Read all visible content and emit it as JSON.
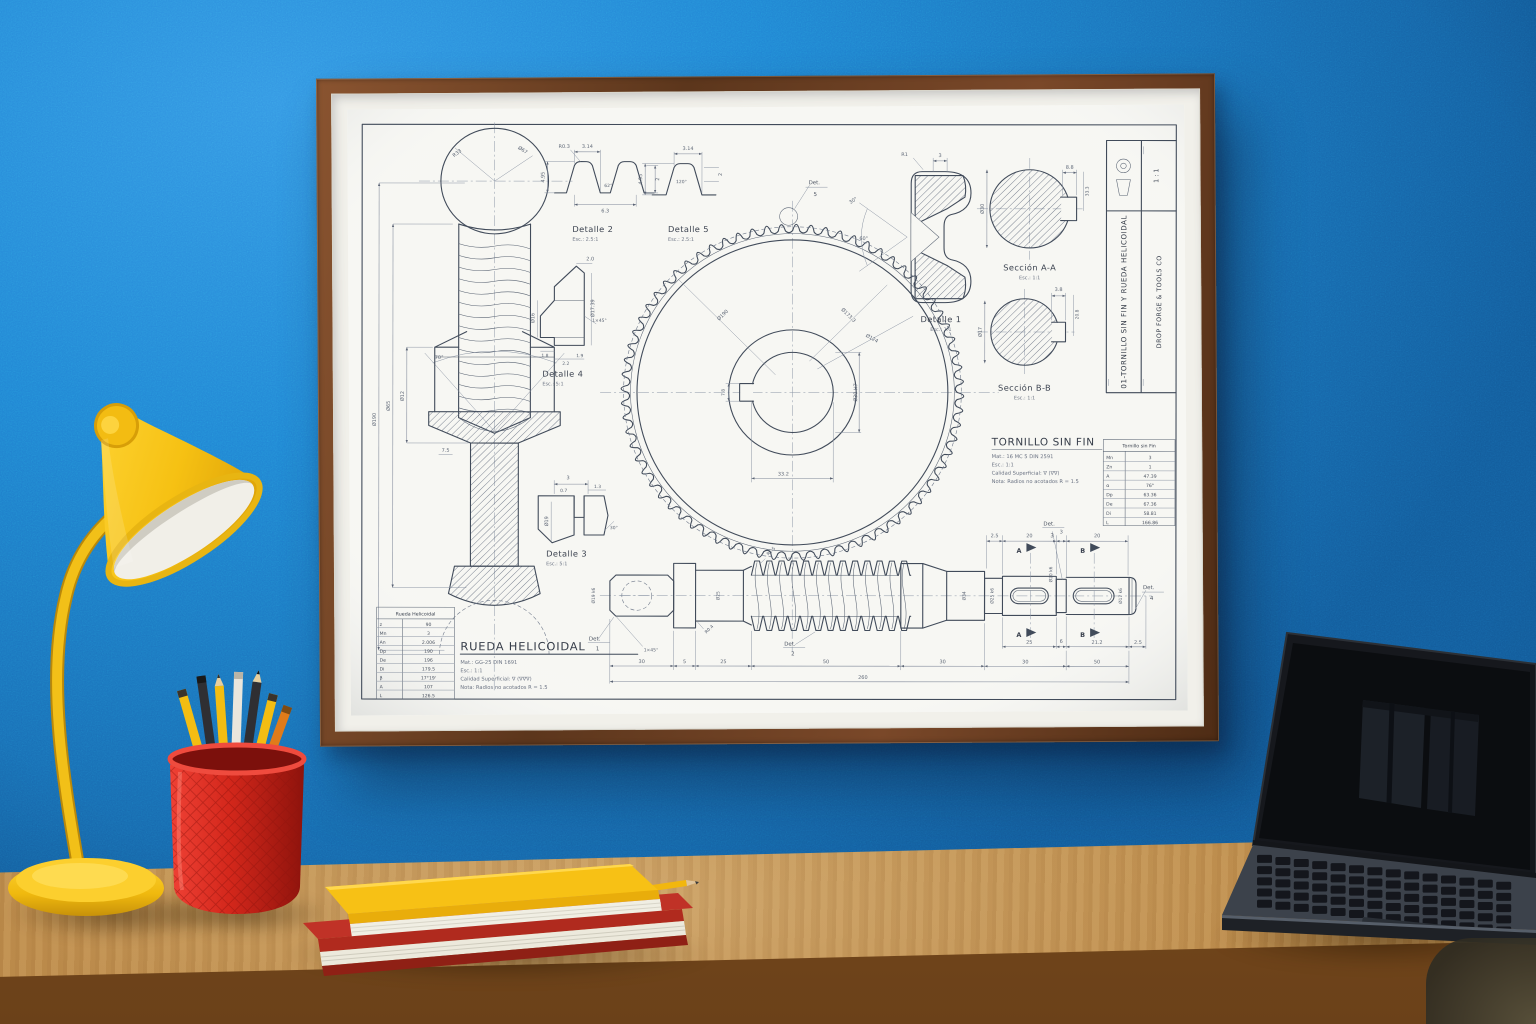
{
  "scene": {
    "description": "Framed mechanical blueprint poster on a textured blue wall above a wooden desk with a yellow lamp, red mesh pencil cup, stacked notebooks and a laptop",
    "wall_color": "#2186d4",
    "desk_color": "#c89a58",
    "frame_wood_color": "#6e4123",
    "paper_color": "#f7f7f3",
    "ink_color": "#414b5a",
    "objects": {
      "lamp": {
        "name": "yellow desk lamp",
        "color": "#f5c41a"
      },
      "pencil_cup": {
        "name": "red mesh pencil cup with pencils",
        "color": "#d92b1f"
      },
      "books": {
        "name": "stacked notebooks with pencil",
        "colors": [
          "#b02a1e",
          "#f7c115"
        ]
      },
      "laptop": {
        "name": "open laptop with dark screen",
        "color": "#2b2f36"
      },
      "chair": {
        "name": "chair corner",
        "color": "#3e3a2c"
      }
    }
  },
  "drawing": {
    "title_block": {
      "title": "01-TORNILLO SIN FIN Y RUEDA HELICOIDAL",
      "company": "DROP FORGE & TOOLS CO",
      "scale": "1 : 1"
    },
    "details": {
      "d1": {
        "label": "Detalle 1",
        "scale": "Esc.: 1:1"
      },
      "d2": {
        "label": "Detalle 2",
        "scale": "Esc.: 2.5:1"
      },
      "d3": {
        "label": "Detalle 3",
        "scale": "Esc.: 5:1"
      },
      "d4": {
        "label": "Detalle 4",
        "scale": "Esc.: 5:1"
      },
      "d5": {
        "label": "Detalle 5",
        "scale": "Esc.: 2.5:1"
      }
    },
    "sections": {
      "a": {
        "label": "Sección A-A",
        "scale": "Esc.: 1:1"
      },
      "b": {
        "label": "Sección B-B",
        "scale": "Esc.: 1:1"
      }
    },
    "worm_block": {
      "title": "TORNILLO SIN FIN",
      "notes": [
        "Mat.: 16 MC 5 DIN 2591",
        "Esc.: 1:1",
        "Calidad Superficial: ∇ (∇∇)",
        "Nota: Radios no acotados R = 1.5"
      ]
    },
    "gear_block": {
      "title": "RUEDA HELICOIDAL",
      "notes": [
        "Mat.: GG-25 DIN 1691",
        "Esc.: 1:1",
        "Calidad Superficial: ∇ (∇∇∇)",
        "Nota: Radios no acotados R = 1.5"
      ]
    },
    "worm_table": {
      "title": "Tornillo sin Fin",
      "rows": [
        [
          "Mn",
          "3"
        ],
        [
          "Zn",
          "1"
        ],
        [
          "A",
          "47.39"
        ],
        [
          "α",
          "76°"
        ],
        [
          "Dp",
          "63.36"
        ],
        [
          "De",
          "67.36"
        ],
        [
          "Di",
          "58.81"
        ],
        [
          "L",
          "166.86"
        ]
      ]
    },
    "gear_table": {
      "title": "Rueda Helicoidal",
      "rows": [
        [
          "z",
          "90"
        ],
        [
          "Mn",
          "3"
        ],
        [
          "An",
          "2.006"
        ],
        [
          "Dp",
          "190"
        ],
        [
          "De",
          "196"
        ],
        [
          "Di",
          "179.5"
        ],
        [
          "β",
          "17°19'"
        ],
        [
          "A",
          "107"
        ],
        [
          "L",
          "126.5"
        ]
      ]
    },
    "callouts": {
      "det": "Det.",
      "n1": "1",
      "n2": "2",
      "n3": "3",
      "n4": "4",
      "n5": "5",
      "a": "A",
      "b": "B"
    },
    "dims": {
      "left_view": [
        "Ø190",
        "Ø65",
        "7.5",
        "Ø12",
        "70°",
        "R33",
        "Ø67"
      ],
      "detail2": [
        "3.14",
        "4.95",
        "R0.3",
        "62°",
        "6.3",
        "2"
      ],
      "detail5": [
        "3.14",
        "4.95",
        "120°",
        "2"
      ],
      "detail4": [
        "2.0",
        "Ø16",
        "Ø17.39",
        "1×45°",
        "1.8",
        "2.2",
        "1.9"
      ],
      "detail3": [
        "3",
        "0.7",
        "1.3",
        "Ø19",
        "30°"
      ],
      "detail1": [
        "3",
        "R1",
        "30°",
        "60°"
      ],
      "gear_front": [
        "Ø190",
        "Ø173.3",
        "Ø124",
        "33.2",
        "Ø30 H7",
        "7.8"
      ],
      "section_a": [
        "8.8",
        "Ø30",
        "33.3"
      ],
      "section_b": [
        "3.8",
        "Ø17",
        "20.8"
      ],
      "shaft_top": [
        "2.5",
        "20",
        "3",
        "20"
      ],
      "shaft_mid": [
        "25",
        "6",
        "21.2",
        "2.5"
      ],
      "shaft_bottom": [
        "30",
        "5",
        "25",
        "50",
        "30",
        "30",
        "50"
      ],
      "shaft_total": "260",
      "shaft_diams": [
        "Ø19 k6",
        "Ø25",
        "Ø34",
        "Ø25 k6",
        "Ø20 k6",
        "Ø17 k6"
      ],
      "shaft_notes": [
        "1×45°",
        "R0.4",
        "R1.5"
      ]
    }
  }
}
